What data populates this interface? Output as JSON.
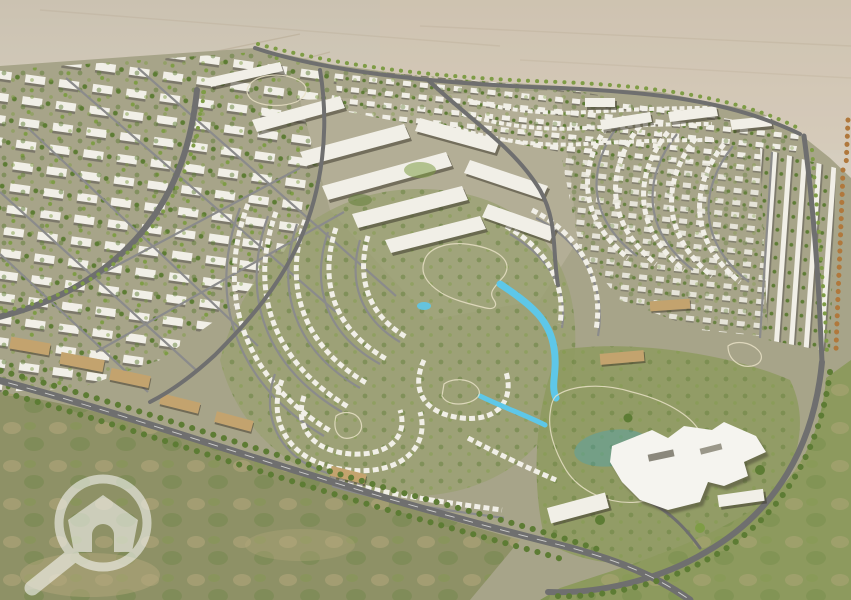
{
  "image": {
    "title": "Aerial masterplan rendering of a desert residential community",
    "description": "3D aerial rendering of a large master-planned community: white apartment blocks and mid-rise slabs on the left, a dense downtown band, concentric curved rows of villas and townhouses around turquoise lagoons, a large white clubhouse beside a lake at lower right, tree-lined boulevards, open desert at the horizon and undeveloped scrubland in the foreground.",
    "width_px": 851,
    "height_px": 600
  },
  "watermark": {
    "icon": "magnifier-house-logo",
    "description": "Semi-transparent white magnifying glass containing a house with arched doorway, bottom-left corner",
    "color": "#ffffff",
    "opacity": 0.55
  },
  "regions": [
    {
      "id": "desert-horizon",
      "label": "Open desert horizon"
    },
    {
      "id": "downtown-band",
      "label": "Dense mid-rise downtown with small teal lake"
    },
    {
      "id": "apartment-district",
      "label": "Apartment block grid (left)"
    },
    {
      "id": "villa-loops",
      "label": "Curved villa and townhouse rows around lagoons (center/right)"
    },
    {
      "id": "lagoon-system",
      "label": "Turquoise lagoons connected by canals"
    },
    {
      "id": "clubhouse",
      "label": "White clubhouse complex beside lake (lower right)"
    },
    {
      "id": "main-boulevard",
      "label": "Tree-lined main boulevard along lower edge"
    },
    {
      "id": "scrubland",
      "label": "Undeveloped scrubland foreground (bottom left)"
    }
  ],
  "palette": {
    "desert_top": "#cbc2b1",
    "desert_mid": "#ddd6c9",
    "desert_low": "#d6cdbd",
    "desert_streak": "#b3a48c",
    "dev_ground": "#a7a489",
    "downtown_ground": "#b3ae96",
    "villa_ground": "#9aa071",
    "grass": "#8d9a5e",
    "scrub": "#8e9166",
    "scrub_patch": "#b4a87b",
    "road": "#6f6f6f",
    "road_minor": "#8b8b8b",
    "road_line": "#e8e8e6",
    "water": "#5ec7e8",
    "water_deep": "#2fa6cf",
    "tree": "#5d7c34",
    "tree_light": "#7e9c45",
    "tree_autumn": "#b0783c",
    "building_white": "#f1efe7",
    "building_shadow": "#7c786a",
    "building_tan": "#c3a36e",
    "clubhouse_white": "#f5f4ef",
    "watermark_white": "#ffffff"
  }
}
